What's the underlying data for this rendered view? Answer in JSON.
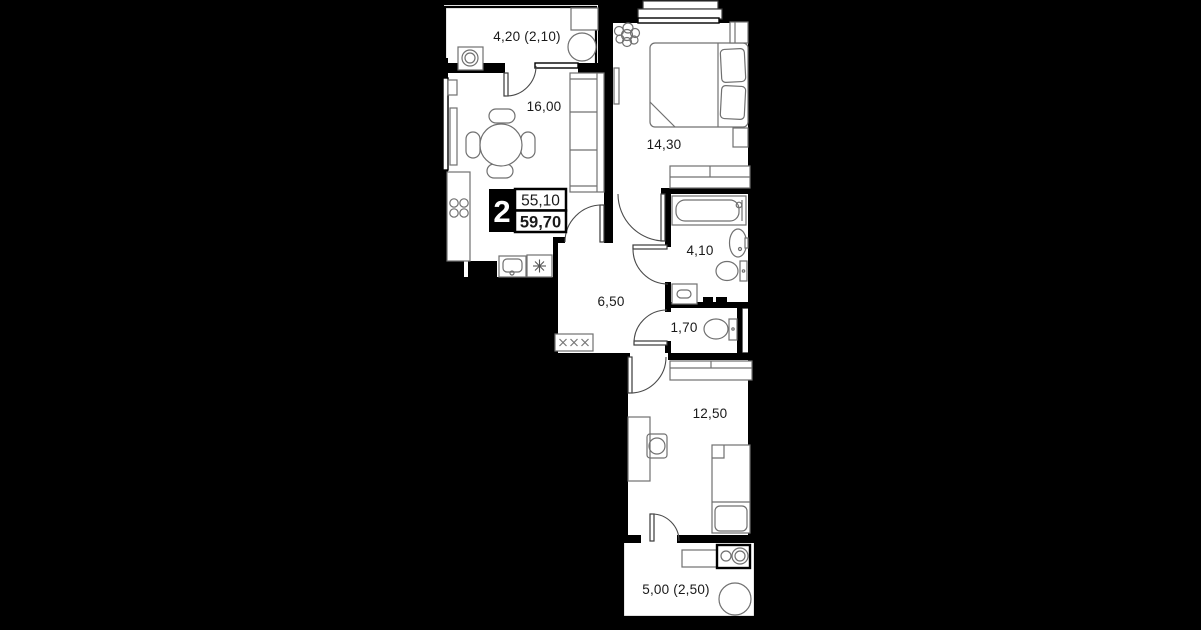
{
  "plan": {
    "type": "apartment-floor-plan",
    "badge": {
      "rooms": "2",
      "area_top": "55,10",
      "area_bottom": "59,70"
    },
    "rooms": [
      {
        "id": "balcony-top",
        "label": "4,20 (2,10)"
      },
      {
        "id": "kitchen-living",
        "label": "16,00"
      },
      {
        "id": "bedroom",
        "label": "14,30"
      },
      {
        "id": "bathroom",
        "label": "4,10"
      },
      {
        "id": "hallway",
        "label": "6,50"
      },
      {
        "id": "wc",
        "label": "1,70"
      },
      {
        "id": "bedroom-2",
        "label": "12,50"
      },
      {
        "id": "balcony-bottom",
        "label": "5,00 (2,50)"
      }
    ],
    "colors": {
      "background": "#000000",
      "floor": "#ffffff",
      "wall": "#000000",
      "furniture_line": "#707070",
      "label_text": "#191919"
    }
  }
}
